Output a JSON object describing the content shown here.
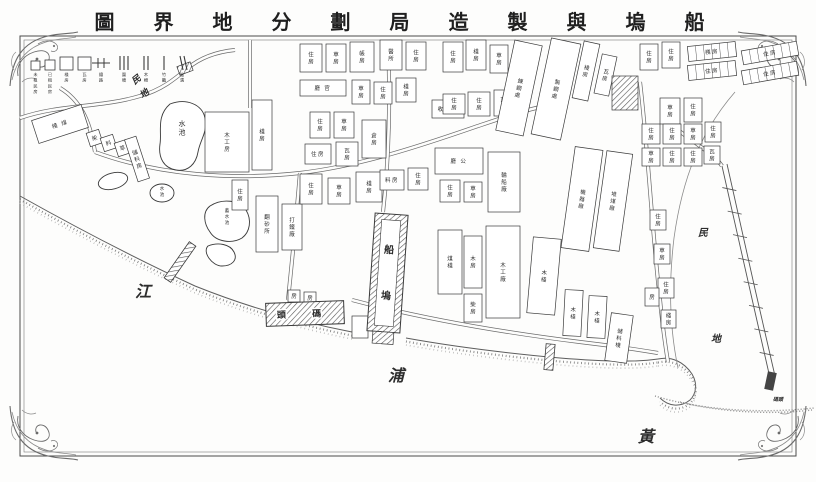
{
  "title": {
    "logical_rtl": "船塢與製造局劃分地界圖",
    "display": "圖 界 地 分 劃 局 造 製 與 塢 船"
  },
  "colors": {
    "ink": "#3a3a3a",
    "paper": "#ffffff",
    "light": "#8a8a8a",
    "water_ink": "#1e1e1e"
  },
  "legend": {
    "squares": [
      {
        "size": 9,
        "label": "未租民房"
      },
      {
        "size": 10,
        "label": "已租民房"
      },
      {
        "size": 13,
        "label": "棧房"
      },
      {
        "size": 13,
        "label": "瓦房"
      }
    ],
    "lines": [
      {
        "type": "rail",
        "label": "鐵路"
      },
      {
        "type": "bars3",
        "label": "圍墻"
      },
      {
        "type": "bars2",
        "label": "木柵"
      },
      {
        "type": "bar1",
        "label": "竹籬"
      },
      {
        "type": "slant2",
        "label": "陰溝"
      }
    ]
  },
  "water_labels": [
    {
      "text": "江",
      "x": 143,
      "y": 297,
      "size": 16,
      "rot": 0
    },
    {
      "text": "浦",
      "x": 396,
      "y": 381,
      "size": 16,
      "rot": 0
    },
    {
      "text": "黃",
      "x": 646,
      "y": 442,
      "size": 16,
      "rot": 0
    }
  ],
  "area_labels": [
    {
      "text": "民",
      "x": 138,
      "y": 82,
      "size": 9,
      "rot": -38
    },
    {
      "text": "地",
      "x": 146,
      "y": 96,
      "size": 9,
      "rot": -38
    },
    {
      "text": "民",
      "x": 703,
      "y": 236,
      "size": 10,
      "rot": 0
    },
    {
      "text": "地",
      "x": 716,
      "y": 342,
      "size": 10,
      "rot": 0
    },
    {
      "text": "碼頭",
      "x": 778,
      "y": 401,
      "size": 5,
      "rot": 0
    }
  ],
  "dock": {
    "chars": [
      "船",
      "塢"
    ],
    "x": 371,
    "y": 214,
    "w": 33,
    "h": 118,
    "rot": 4
  },
  "wharf": {
    "label": "頭 碼",
    "x": 266,
    "y": 302,
    "w": 78,
    "h": 23,
    "rot": -2
  },
  "buildings": [
    [
      34,
      112,
      52,
      24,
      -18,
      "棧 煤",
      "h",
      null
    ],
    [
      88,
      131,
      13,
      14,
      -18,
      "柴",
      "v",
      null
    ],
    [
      102,
      136,
      13,
      14,
      -18,
      "料",
      "v",
      null
    ],
    [
      116,
      141,
      13,
      14,
      -18,
      "草",
      "v",
      null
    ],
    [
      131,
      137,
      12,
      44,
      -18,
      "儲料房",
      "v",
      null
    ],
    [
      205,
      112,
      44,
      60,
      0,
      "木工房",
      "v",
      null
    ],
    [
      252,
      100,
      20,
      70,
      0,
      "棧房",
      "v",
      null
    ],
    [
      232,
      180,
      16,
      30,
      0,
      "住房",
      "v",
      null
    ],
    [
      256,
      196,
      22,
      56,
      0,
      "翻砂所",
      "v",
      null
    ],
    [
      282,
      204,
      20,
      46,
      0,
      "打鐵廠",
      "v",
      null
    ],
    [
      300,
      44,
      22,
      28,
      0,
      "住房",
      "v",
      null
    ],
    [
      326,
      44,
      20,
      28,
      0,
      "草房",
      "v",
      null
    ],
    [
      350,
      42,
      24,
      30,
      0,
      "帳房",
      "v",
      null
    ],
    [
      380,
      40,
      22,
      30,
      0,
      "醫所",
      "v",
      null
    ],
    [
      406,
      42,
      20,
      28,
      0,
      "住房",
      "v",
      null
    ],
    [
      300,
      80,
      46,
      16,
      0,
      "廳 官",
      "h",
      null
    ],
    [
      352,
      80,
      18,
      24,
      0,
      "草房",
      "v",
      null
    ],
    [
      374,
      82,
      18,
      22,
      0,
      "住房",
      "v",
      null
    ],
    [
      396,
      78,
      20,
      24,
      0,
      "棧房",
      "v",
      null
    ],
    [
      310,
      112,
      20,
      26,
      0,
      "住房",
      "v",
      null
    ],
    [
      334,
      112,
      20,
      26,
      0,
      "草房",
      "v",
      null
    ],
    [
      305,
      144,
      26,
      20,
      0,
      "住房",
      "h",
      null
    ],
    [
      336,
      142,
      22,
      24,
      0,
      "瓦房",
      "v",
      null
    ],
    [
      362,
      120,
      24,
      38,
      0,
      "倉房",
      "v",
      null
    ],
    [
      300,
      174,
      22,
      30,
      0,
      "住房",
      "v",
      null
    ],
    [
      328,
      178,
      22,
      26,
      0,
      "草房",
      "v",
      null
    ],
    [
      356,
      172,
      26,
      30,
      0,
      "棧房",
      "v",
      null
    ],
    [
      380,
      170,
      24,
      20,
      0,
      "料房",
      "h",
      null
    ],
    [
      408,
      168,
      20,
      22,
      0,
      "住房",
      "v",
      null
    ],
    [
      432,
      100,
      32,
      18,
      0,
      "收支所",
      "h",
      null
    ],
    [
      435,
      148,
      48,
      26,
      0,
      "廳 公",
      "h",
      null
    ],
    [
      488,
      152,
      32,
      60,
      0,
      "輪船廠",
      "v",
      null
    ],
    [
      440,
      180,
      20,
      22,
      0,
      "住房",
      "v",
      null
    ],
    [
      464,
      182,
      18,
      20,
      0,
      "草房",
      "v",
      null
    ],
    [
      443,
      42,
      20,
      30,
      0,
      "住房",
      "v",
      null
    ],
    [
      466,
      40,
      20,
      30,
      0,
      "棧房",
      "v",
      null
    ],
    [
      490,
      45,
      18,
      28,
      0,
      "草房",
      "v",
      null
    ],
    [
      443,
      94,
      22,
      20,
      0,
      "住房",
      "v",
      null
    ],
    [
      468,
      92,
      22,
      24,
      0,
      "住房",
      "v",
      null
    ],
    [
      494,
      90,
      18,
      26,
      0,
      "瓦房",
      "v",
      null
    ],
    [
      505,
      42,
      28,
      92,
      12,
      "鍊鋼處",
      "v",
      null
    ],
    [
      541,
      40,
      30,
      98,
      12,
      "製鋼處",
      "v",
      null
    ],
    [
      578,
      42,
      16,
      58,
      12,
      "棧房",
      "v",
      null
    ],
    [
      598,
      55,
      15,
      40,
      12,
      "瓦房",
      "v",
      null
    ],
    [
      612,
      76,
      26,
      34,
      0,
      "",
      "v",
      "hatch"
    ],
    [
      640,
      44,
      18,
      26,
      0,
      "住房",
      "v",
      null
    ],
    [
      662,
      42,
      18,
      26,
      0,
      "住房",
      "v",
      null
    ],
    [
      688,
      44,
      48,
      15,
      -6,
      "棧房",
      "h",
      "div"
    ],
    [
      688,
      63,
      48,
      15,
      -6,
      "住房",
      "h",
      "div"
    ],
    [
      742,
      46,
      56,
      14,
      -10,
      "住房",
      "h",
      "div"
    ],
    [
      742,
      66,
      56,
      14,
      -10,
      "住房",
      "h",
      "div"
    ],
    [
      660,
      98,
      20,
      26,
      0,
      "草房",
      "v",
      null
    ],
    [
      684,
      98,
      18,
      24,
      0,
      "住房",
      "v",
      null
    ],
    [
      642,
      124,
      18,
      20,
      0,
      "住房",
      "v",
      null
    ],
    [
      663,
      124,
      18,
      20,
      0,
      "住房",
      "v",
      null
    ],
    [
      684,
      124,
      18,
      20,
      0,
      "草房",
      "v",
      null
    ],
    [
      705,
      122,
      16,
      20,
      0,
      "住房",
      "v",
      null
    ],
    [
      642,
      148,
      18,
      18,
      0,
      "草房",
      "v",
      null
    ],
    [
      663,
      148,
      18,
      18,
      0,
      "住房",
      "v",
      null
    ],
    [
      684,
      148,
      18,
      18,
      0,
      "住房",
      "v",
      null
    ],
    [
      704,
      146,
      16,
      18,
      0,
      "瓦房",
      "v",
      null
    ],
    [
      568,
      148,
      28,
      102,
      8,
      "機器廠",
      "v",
      null
    ],
    [
      600,
      152,
      26,
      98,
      8,
      "堆煤廠",
      "v",
      null
    ],
    [
      650,
      210,
      16,
      20,
      0,
      "住房",
      "v",
      null
    ],
    [
      654,
      244,
      16,
      20,
      0,
      "草房",
      "v",
      null
    ],
    [
      658,
      278,
      16,
      20,
      0,
      "住房",
      "v",
      null
    ],
    [
      661,
      310,
      15,
      18,
      0,
      "棧房",
      "v",
      null
    ],
    [
      438,
      230,
      24,
      64,
      0,
      "煤棧",
      "v",
      null
    ],
    [
      464,
      236,
      18,
      52,
      0,
      "木房",
      "v",
      null
    ],
    [
      486,
      226,
      34,
      92,
      0,
      "木工廠",
      "v",
      null
    ],
    [
      464,
      294,
      18,
      28,
      0,
      "柴房",
      "v",
      null
    ],
    [
      530,
      238,
      28,
      76,
      5,
      "木棧",
      "v",
      null
    ],
    [
      564,
      290,
      18,
      46,
      3,
      "木棧",
      "v",
      null
    ],
    [
      588,
      296,
      18,
      42,
      3,
      "木棧",
      "v",
      null
    ],
    [
      608,
      314,
      22,
      48,
      8,
      "儲料棧",
      "v",
      null
    ],
    [
      645,
      288,
      14,
      18,
      0,
      "房",
      "v",
      null
    ],
    [
      288,
      290,
      12,
      12,
      0,
      "房",
      "v",
      null
    ],
    [
      304,
      292,
      12,
      12,
      0,
      "房",
      "v",
      null
    ],
    [
      352,
      316,
      16,
      22,
      0,
      "",
      "v",
      null
    ],
    [
      178,
      64,
      14,
      9,
      -20,
      "",
      "v",
      "hatch"
    ]
  ],
  "ponds": [
    {
      "type": "path",
      "d": "M170,104 C186,98 202,104 205,118 C208,132 200,140 198,152 C196,164 188,172 176,170 C164,168 158,158 160,144 C162,132 156,116 170,104 Z",
      "label": "水池",
      "lx": 182,
      "ly": 126,
      "lsize": 7
    },
    {
      "type": "ellipse",
      "cx": 162,
      "cy": 193,
      "rx": 12,
      "ry": 9,
      "rot": 0,
      "label": "水池",
      "lx": 162,
      "ly": 190,
      "lsize": 4.5
    },
    {
      "type": "ellipse",
      "cx": 113,
      "cy": 181,
      "rx": 15,
      "ry": 8,
      "rot": -15,
      "label": "",
      "lx": 0,
      "ly": 0,
      "lsize": 4
    },
    {
      "type": "path",
      "d": "M210,206 C222,198 240,200 246,210 C252,220 250,232 242,238 C232,244 216,242 210,232 C204,224 202,212 210,206 Z",
      "label": "蓄水池",
      "lx": 227,
      "ly": 212,
      "lsize": 4.5
    },
    {
      "type": "path",
      "d": "M208,246 C218,242 230,244 234,252 C238,260 232,266 222,266 C212,266 202,252 208,246 Z",
      "label": "",
      "lx": 0,
      "ly": 0,
      "lsize": 4
    }
  ],
  "roads": [
    "M95,152 C160,176 235,180 300,173 C360,166 420,146 475,127 C505,117 525,110 545,106",
    "M388,40 C390,90 390,150 383,212",
    "M300,173 C296,220 292,262 288,300",
    "M640,82 C648,150 652,230 660,300 C663,330 666,350 668,362",
    "M662,118 C690,140 715,155 722,166",
    "M352,300 C420,318 500,332 580,342 C615,346 640,350 658,353",
    "M95,152 C90,120 80,100 60,88",
    "M250,40 L250,108",
    "M20,118 C60,104 100,108 140,96 C162,90 176,78 188,68 C200,58 215,52 235,50"
  ],
  "boundary": "M735,92 C700,132 682,180 674,238 C668,288 670,330 678,368",
  "shore": [
    "M20,196 C70,224 130,256 195,286 C245,306 300,322 352,332",
    "M406,338 C450,346 505,353 560,358 C610,362 638,362 658,359",
    "M658,359 C672,356 684,362 692,374 C698,384 696,394 690,400 C680,408 668,406 660,398"
  ],
  "grass": [
    "M655,396 C700,410 760,414 814,408",
    "M680,402 C720,412 770,415 812,410"
  ],
  "piers": {
    "small": [
      {
        "x": 176,
        "y": 240,
        "w": 8,
        "h": 44,
        "rot": 35
      },
      {
        "x": 545,
        "y": 344,
        "w": 9,
        "h": 26,
        "rot": 5
      }
    ],
    "long_pier": {
      "line1": "M722,166 L750,290 L770,378",
      "line2": "M727,164 L755,289 L775,376",
      "ticks": 8,
      "tip": {
        "x": 766,
        "y": 372,
        "w": 9,
        "h": 18,
        "rot": 12
      }
    }
  }
}
